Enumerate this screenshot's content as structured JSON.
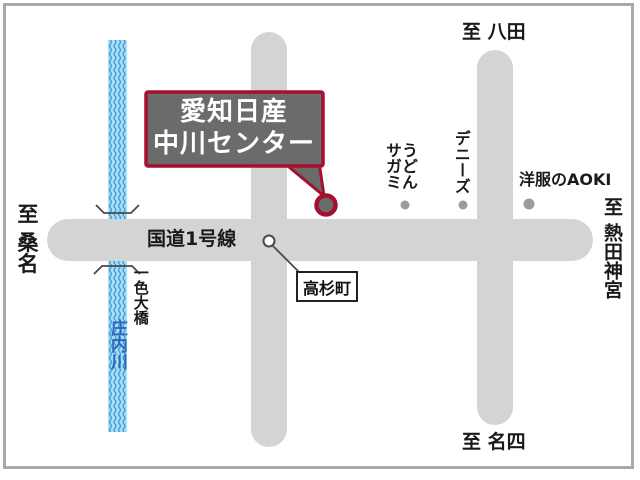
{
  "map": {
    "destination": {
      "label": "愛知日産\n中川センター"
    },
    "roads": {
      "route1_label": "国道1号線"
    },
    "intersection": {
      "label": "高杉町"
    },
    "directions": {
      "west": "至 桑名",
      "north": "至 八田",
      "east": "至 熱田神宮",
      "south": "至 名四"
    },
    "river": {
      "name": "庄内川"
    },
    "bridge": {
      "name": "一色大橋"
    },
    "pois": [
      {
        "label": "うどん\nサガミ"
      },
      {
        "label": "デニーズ"
      },
      {
        "label": "洋服のAOKI"
      }
    ]
  },
  "colors": {
    "road_gray": "#d4d4d4",
    "river_fill": "#a9dcf6",
    "river_wave": "#3f9fdc",
    "river_text": "#2a6ab8",
    "callout_fill": "#6b6b6b",
    "callout_border": "#a5102f",
    "marker_fill": "#6b6b6b",
    "marker_ring": "#a5102f",
    "poi_dot": "#9c9c9c",
    "line_ink": "#4a4a4a",
    "frame_border": "#a9a9a9"
  }
}
